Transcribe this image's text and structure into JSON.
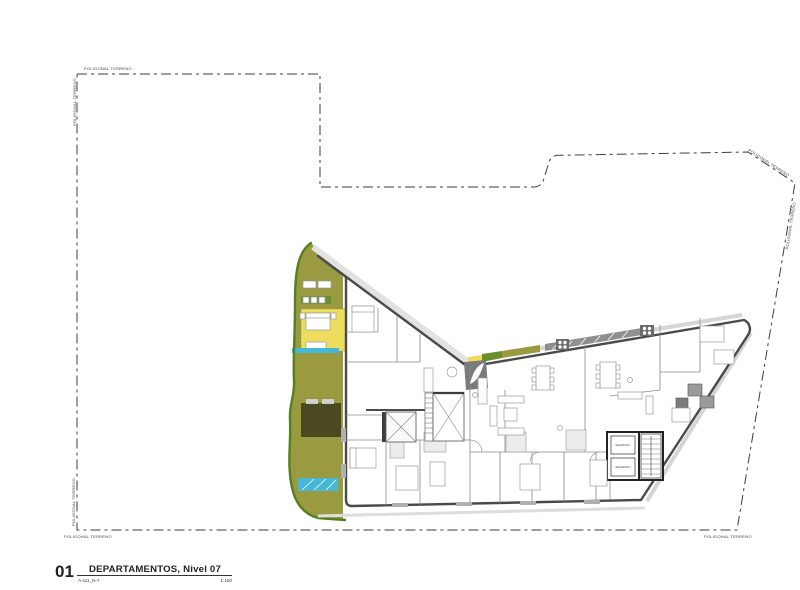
{
  "sheet": {
    "boundary_label": "POLIGONAL TERRENO",
    "title_block": {
      "number": "01",
      "code": "A-111_N-7",
      "title": "DEPARTAMENTOS, Nivel 07",
      "scale": "1:150"
    },
    "elevators": {
      "car1": "ELEVADOR 1",
      "car2": "ELEVADOR 2"
    },
    "colors": {
      "terrace_olive": "#9a9b41",
      "room_yellow": "#eedd5c",
      "water_cyan": "#45b8d8",
      "dark_olive": "#4b491f",
      "edge_green": "#54801f",
      "accent_green": "#6b8f2f",
      "wall_dark": "#4a4a4a",
      "balcony_gray": "#8f8f8f"
    }
  }
}
